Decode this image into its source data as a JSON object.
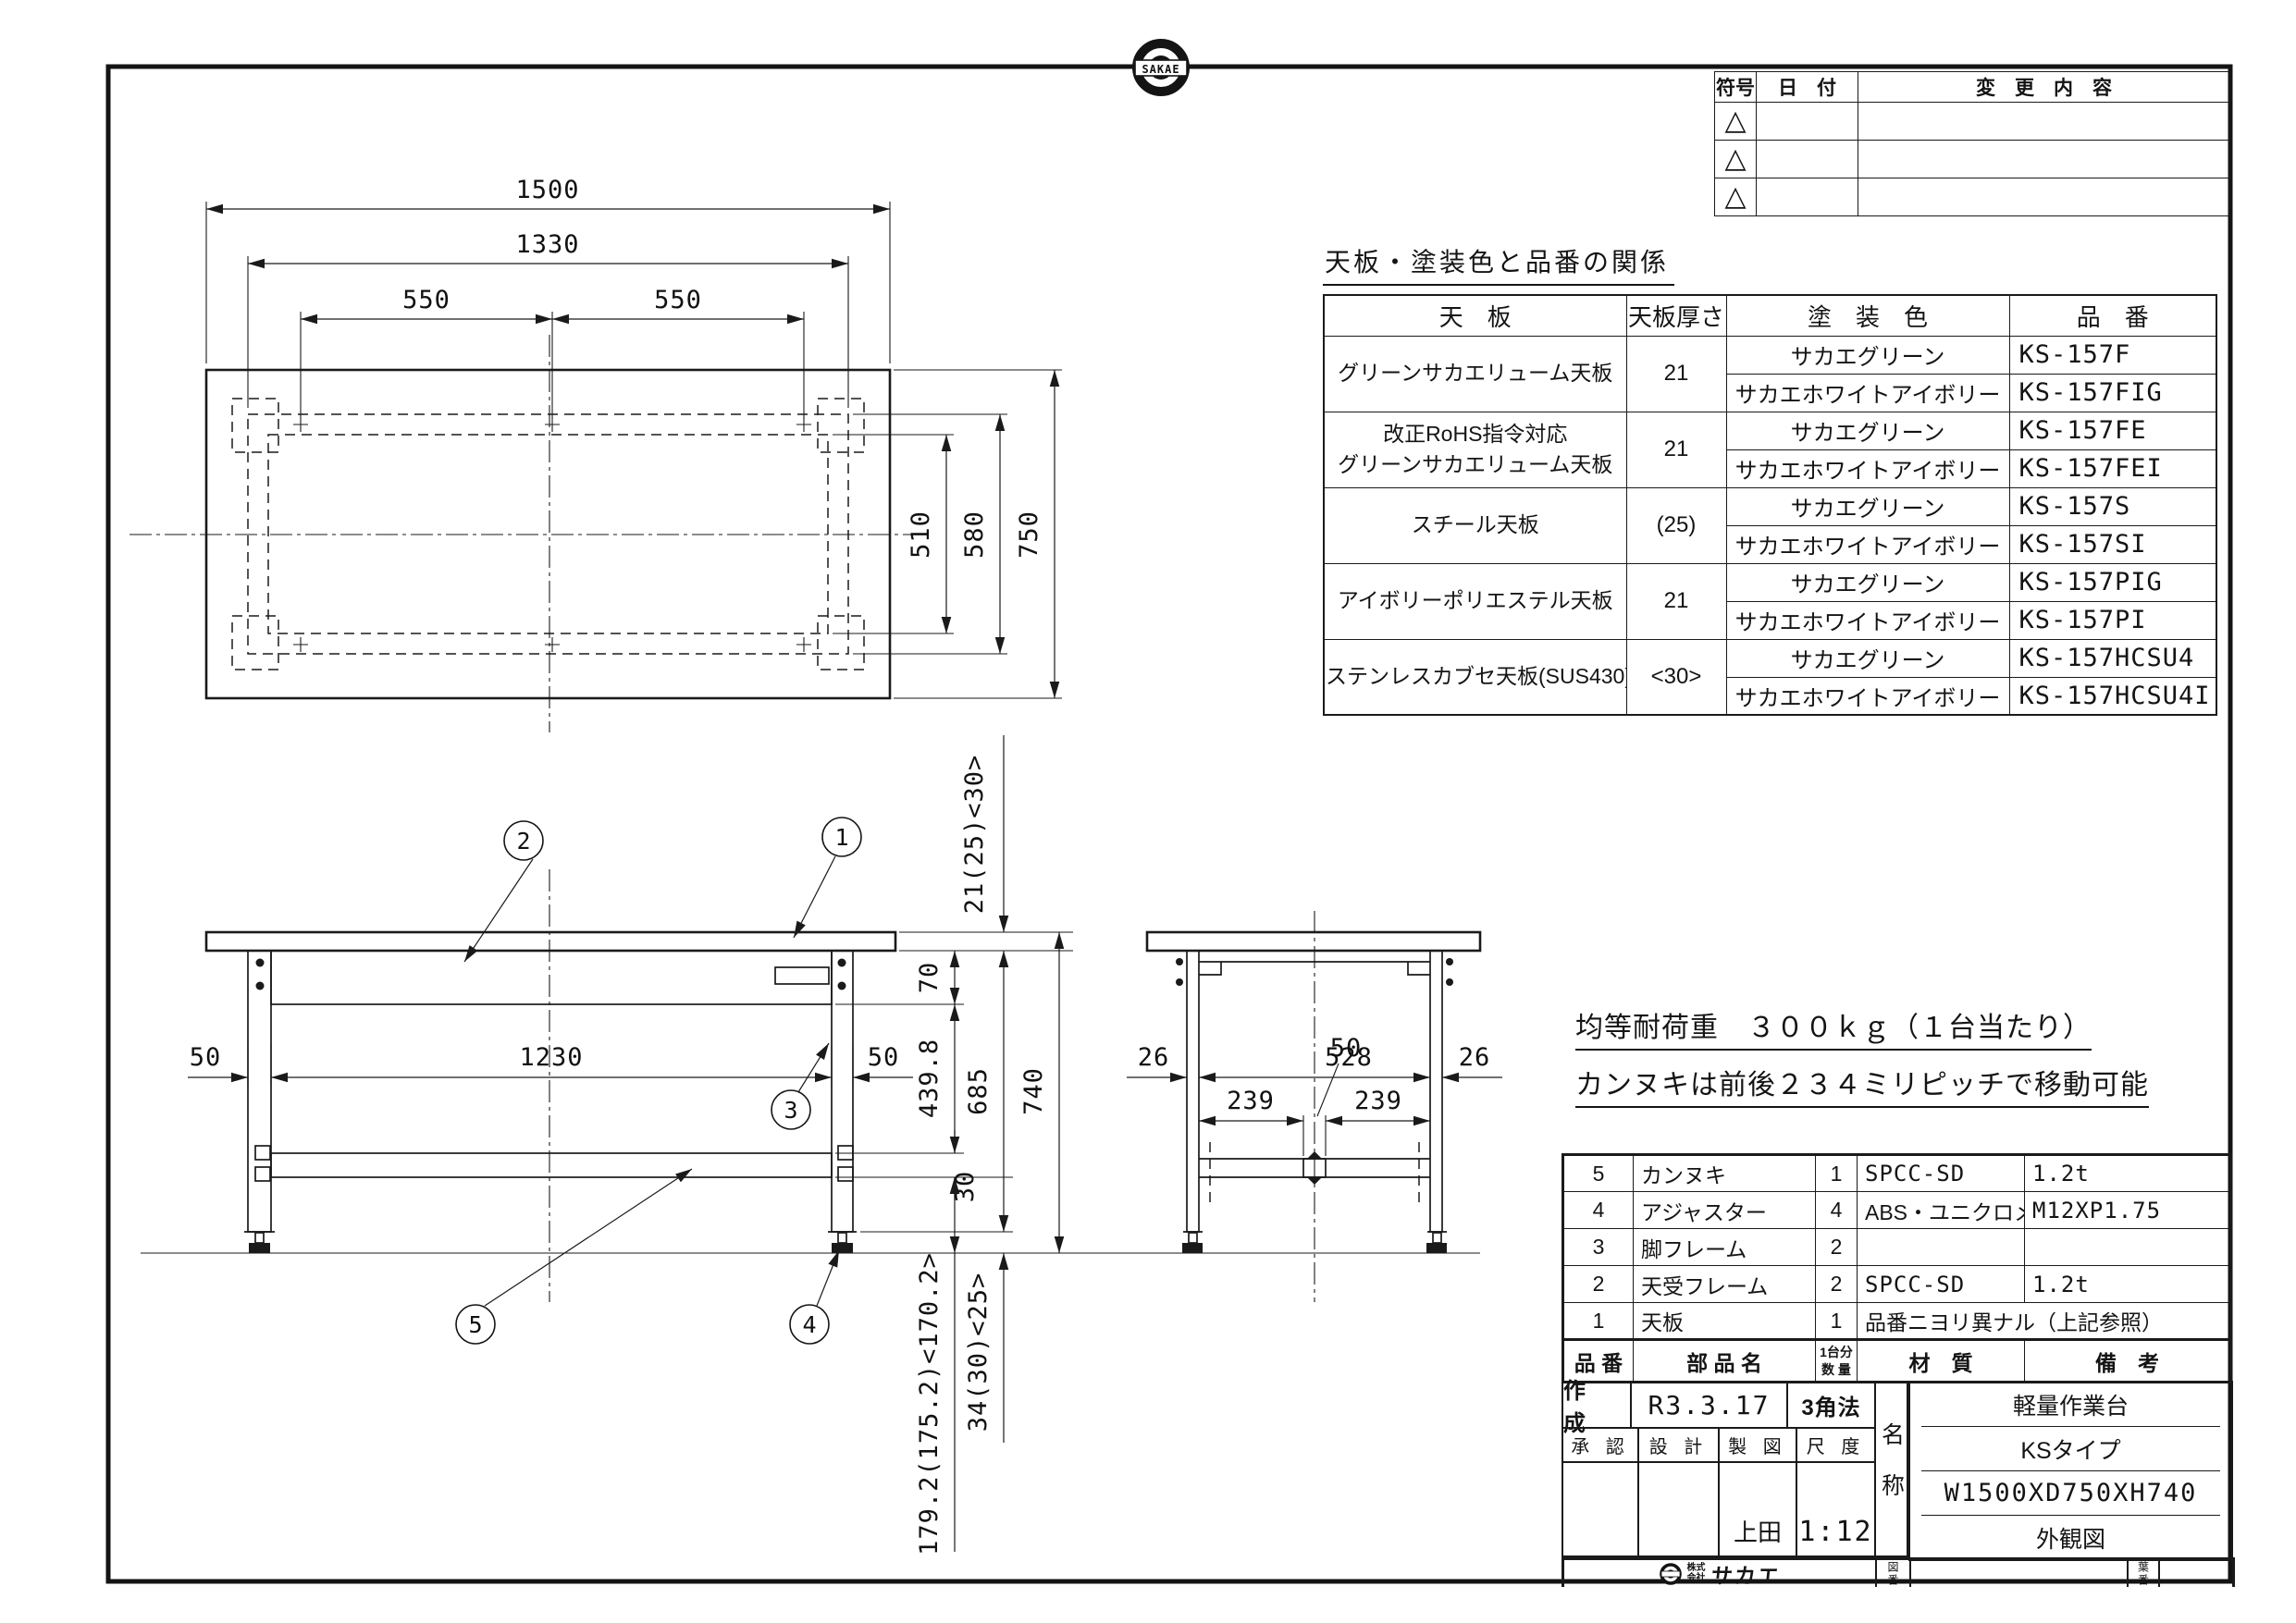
{
  "sheet": {
    "top_logo_text": "SAKAE",
    "company_prefix_top": "株式",
    "company_prefix_bottom": "会社",
    "company_name": "サカエ"
  },
  "revision": {
    "headers": {
      "symbol": "符号",
      "date": "日　付",
      "change": "変　更　内　容"
    },
    "triangle": "△"
  },
  "spec": {
    "title": "天板・塗装色と品番の関係",
    "headers": {
      "plate": "天　板",
      "thickness": "天板厚さ",
      "color": "塗　装　色",
      "part_no": "品　番"
    },
    "groups": [
      {
        "plate": "グリーンサカエリューム天板",
        "thickness": "21",
        "rows": [
          {
            "color": "サカエグリーン",
            "part_no": "KS-157F"
          },
          {
            "color": "サカエホワイトアイボリー",
            "part_no": "KS-157FIG"
          }
        ]
      },
      {
        "plate": "改正RoHS指令対応",
        "plate2": "グリーンサカエリューム天板",
        "thickness": "21",
        "rows": [
          {
            "color": "サカエグリーン",
            "part_no": "KS-157FE"
          },
          {
            "color": "サカエホワイトアイボリー",
            "part_no": "KS-157FEI"
          }
        ]
      },
      {
        "plate": "スチール天板",
        "thickness": "(25)",
        "rows": [
          {
            "color": "サカエグリーン",
            "part_no": "KS-157S"
          },
          {
            "color": "サカエホワイトアイボリー",
            "part_no": "KS-157SI"
          }
        ]
      },
      {
        "plate": "アイボリーポリエステル天板",
        "thickness": "21",
        "rows": [
          {
            "color": "サカエグリーン",
            "part_no": "KS-157PIG"
          },
          {
            "color": "サカエホワイトアイボリー",
            "part_no": "KS-157PI"
          }
        ]
      },
      {
        "plate": "ステンレスカブセ天板(SUS430)",
        "thickness": "<30>",
        "rows": [
          {
            "color": "サカエグリーン",
            "part_no": "KS-157HCSU4"
          },
          {
            "color": "サカエホワイトアイボリー",
            "part_no": "KS-157HCSU4I"
          }
        ]
      }
    ]
  },
  "notes": {
    "load": "均等耐荷重　３００ｋｇ（１台当たり）",
    "pitch": "カンヌキは前後２３４ミリピッチで移動可能"
  },
  "parts": {
    "headers": {
      "no": "品 番",
      "name": "部 品 名",
      "qty_l1": "1台分",
      "qty_l2": "数 量",
      "material": "材　質",
      "remarks": "備　考"
    },
    "rows": [
      {
        "no": "5",
        "name": "カンヌキ",
        "qty": "1",
        "material": "SPCC-SD",
        "remarks": "1.2t"
      },
      {
        "no": "4",
        "name": "アジャスター",
        "qty": "4",
        "material": "ABS・ユニクロメッキ",
        "remarks": "M12XP1.75"
      },
      {
        "no": "3",
        "name": "脚フレーム",
        "qty": "2",
        "material": "",
        "remarks": ""
      },
      {
        "no": "2",
        "name": "天受フレーム",
        "qty": "2",
        "material": "SPCC-SD",
        "remarks": "1.2t"
      },
      {
        "no": "1",
        "name": "天板",
        "qty": "1",
        "material": "品番ニヨリ異ナル（上記参照）",
        "remarks": ""
      }
    ]
  },
  "title_block": {
    "created_label": "作 成",
    "created_date": "R3.3.17",
    "projection": "3角法",
    "approve_label": "承 認",
    "design_label": "設 計",
    "draft_label": "製 図",
    "scale_label": "尺 度",
    "drafter": "上田",
    "scale": "1:12",
    "name_label": "名称",
    "name_line1": "軽量作業台",
    "name_line2": "KSタイプ",
    "name_line3": "W1500XD750XH740",
    "name_line4": "外観図",
    "drawing_no_label": "図番",
    "sheet_no_label": "葉番"
  },
  "plan": {
    "dims": {
      "w1500": "1500",
      "w1330": "1330",
      "p550a": "550",
      "p550b": "550",
      "d510": "510",
      "d580": "580",
      "d750": "750"
    }
  },
  "front": {
    "dims": {
      "leg50l": "50",
      "span1230": "1230",
      "leg50r": "50",
      "thick": "21(25)<30>",
      "apron70": "70",
      "mid": "439.8",
      "rail30": "30",
      "under685": "685",
      "total740": "740",
      "clearance": "179.2(175.2)<170.2>",
      "adjuster": "34(30)<25>"
    },
    "callouts": [
      "1",
      "2",
      "3",
      "4",
      "5"
    ]
  },
  "side": {
    "dims": {
      "d26l": "26",
      "span528": "528",
      "d26r": "26",
      "rail50": "50",
      "p239f": "239",
      "p239b": "239"
    }
  }
}
